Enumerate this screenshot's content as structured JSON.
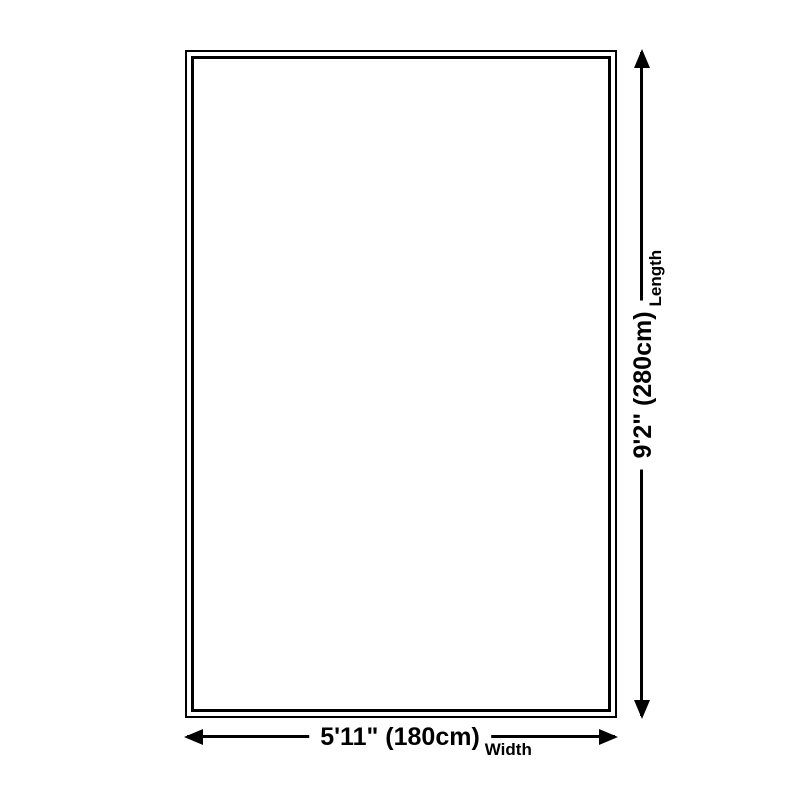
{
  "diagram": {
    "type": "product-dimension-diagram",
    "background_color": "#ffffff",
    "outline_color": "#000000",
    "text_color": "#000000",
    "labels": {
      "width": {
        "value": "5'11\" (180cm)",
        "unit": "Width"
      },
      "length": {
        "value": "9'2\" (280cm)",
        "unit": "Length"
      }
    }
  }
}
